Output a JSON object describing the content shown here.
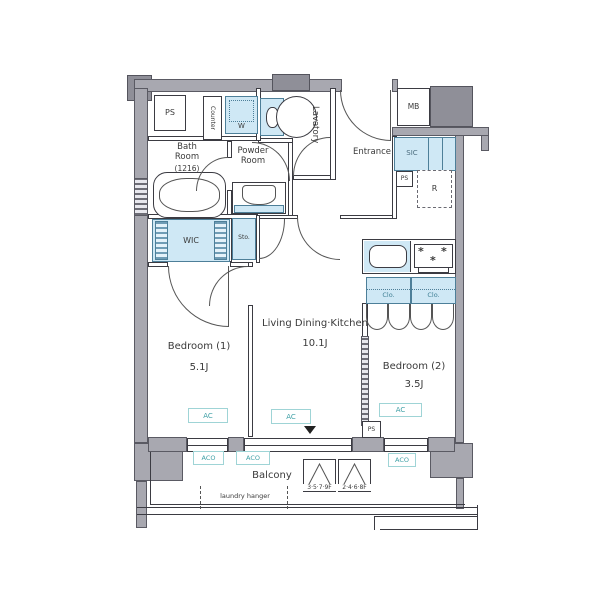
{
  "colors": {
    "wall": "#a8a8b0",
    "fixture_blue": "#cfe8f5",
    "ac_teal": "#3fa0a6",
    "line": "#3b3b42"
  },
  "rooms": {
    "bath": {
      "name": "Bath Room",
      "size": "(1216)"
    },
    "powder": {
      "name": "Powder Room"
    },
    "lavatory": {
      "name": "Lavatory"
    },
    "entrance": {
      "name": "Entrance"
    },
    "bedroom1": {
      "name": "Bedroom (1)",
      "size": "5.1J"
    },
    "ldk": {
      "name": "Living Dining·Kitchen",
      "size": "10.1J"
    },
    "bedroom2": {
      "name": "Bedroom (2)",
      "size": "3.5J"
    },
    "balcony": {
      "name": "Balcony"
    }
  },
  "fixtures": {
    "ps": "PS",
    "counter": "Counter",
    "washer": "W",
    "meter_box": "MB",
    "shoe_closet": "SIC",
    "fridge": "R",
    "walk_in_closet": "WIC",
    "storage": "Sto.",
    "closet": "Clo.",
    "ac": "AC",
    "aco": "ACO",
    "laundry_hanger": "laundry hanger",
    "floor_sign_a": "3·5·7·9F",
    "floor_sign_b": "2·4·6·8F"
  }
}
